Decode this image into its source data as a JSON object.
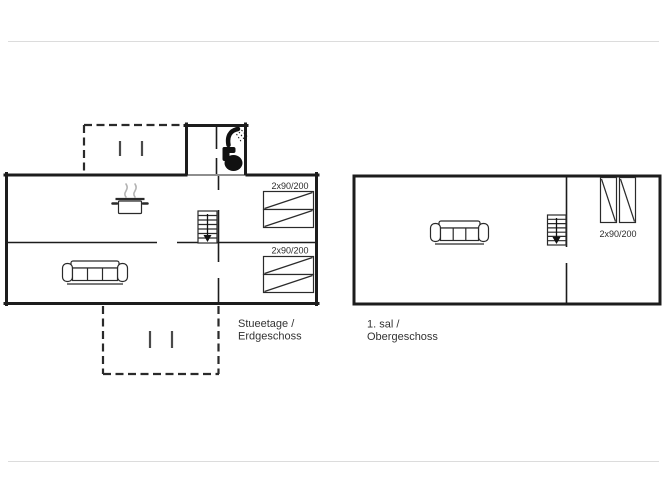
{
  "image": {
    "background": "#ffffff",
    "line_color": "#1c1c1c",
    "frame_rule_color": "#dcdcdc",
    "steam_color": "#b3b3b3"
  },
  "floors": [
    {
      "name": "ground-floor",
      "caption_line1": "Stueetage /",
      "caption_line2": "Erdgeschoss",
      "bed_size_labels": [
        "2x90/200",
        "2x90/200"
      ],
      "icons": [
        "shower-icon",
        "toilet-icon",
        "stove-pot-icon",
        "stairs-down-icon",
        "sofa-icon",
        "bed-pair-icon",
        "bed-pair-icon",
        "terrace-dashed-outline",
        "terrace-dashed-outline",
        "door-tick-icon"
      ]
    },
    {
      "name": "upper-floor",
      "caption_line1": "1. sal /",
      "caption_line2": "Obergeschoss",
      "bed_size_labels": [
        "2x90/200"
      ],
      "icons": [
        "sofa-icon",
        "stairs-down-icon",
        "bed-pair-icon"
      ]
    }
  ]
}
